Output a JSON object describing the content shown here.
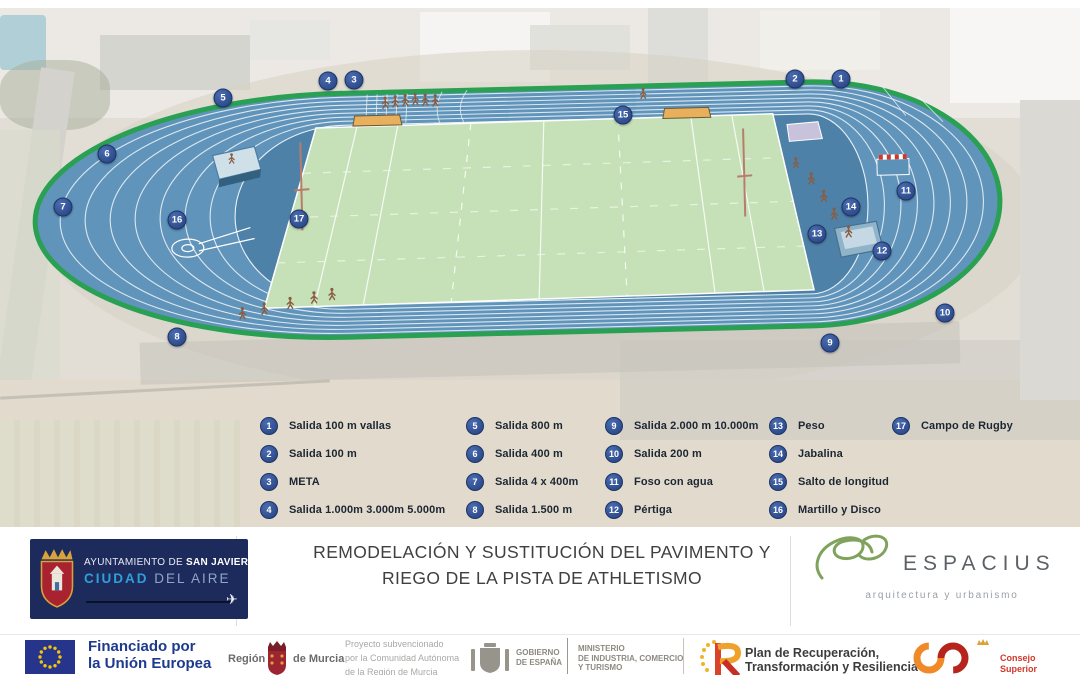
{
  "colors": {
    "track_blue": "#6094ba",
    "track_inner_blue": "#4e81a8",
    "border_green": "#2aa053",
    "field_green": "#c6e0b8",
    "marker_navy": "#2e4d90",
    "footer_navy": "#1d2a5c",
    "city_cyan": "#2f9fd8",
    "eu_blue": "#26348b",
    "eu_star_gold": "#f2c40f",
    "espacius_green": "#7fa35c",
    "csd_orange": "#f08a28",
    "csd_red": "#b5251c",
    "plan_red": "#d8432a",
    "murcia_red": "#9c2531"
  },
  "stadium": {
    "markers": [
      {
        "n": 1,
        "x": 841,
        "y": 79
      },
      {
        "n": 2,
        "x": 795,
        "y": 79
      },
      {
        "n": 3,
        "x": 354,
        "y": 80
      },
      {
        "n": 4,
        "x": 328,
        "y": 81
      },
      {
        "n": 5,
        "x": 223,
        "y": 98
      },
      {
        "n": 6,
        "x": 107,
        "y": 154
      },
      {
        "n": 7,
        "x": 63,
        "y": 207
      },
      {
        "n": 8,
        "x": 177,
        "y": 337
      },
      {
        "n": 9,
        "x": 830,
        "y": 343
      },
      {
        "n": 10,
        "x": 945,
        "y": 313
      },
      {
        "n": 11,
        "x": 906,
        "y": 191
      },
      {
        "n": 12,
        "x": 882,
        "y": 251
      },
      {
        "n": 13,
        "x": 817,
        "y": 234
      },
      {
        "n": 14,
        "x": 851,
        "y": 207
      },
      {
        "n": 15,
        "x": 623,
        "y": 115
      },
      {
        "n": 16,
        "x": 177,
        "y": 220
      },
      {
        "n": 17,
        "x": 299,
        "y": 219
      }
    ]
  },
  "legend": {
    "columns": [
      {
        "items": [
          {
            "n": 1,
            "label": "Salida 100 m vallas"
          },
          {
            "n": 2,
            "label": "Salida 100 m"
          },
          {
            "n": 3,
            "label": "META"
          },
          {
            "n": 4,
            "label": "Salida 1.000m 3.000m 5.000m"
          }
        ]
      },
      {
        "items": [
          {
            "n": 5,
            "label": "Salida 800 m"
          },
          {
            "n": 6,
            "label": "Salida 400 m"
          },
          {
            "n": 7,
            "label": "Salida 4 x 400m"
          },
          {
            "n": 8,
            "label": "Salida 1.500 m"
          }
        ]
      },
      {
        "items": [
          {
            "n": 9,
            "label": "Salida 2.000 m 10.000m"
          },
          {
            "n": 10,
            "label": "Salida 200 m"
          },
          {
            "n": 11,
            "label": "Foso con agua"
          },
          {
            "n": 12,
            "label": "Pértiga"
          }
        ]
      },
      {
        "items": [
          {
            "n": 13,
            "label": "Peso"
          },
          {
            "n": 14,
            "label": "Jabalina"
          },
          {
            "n": 15,
            "label": "Salto de longitud"
          },
          {
            "n": 16,
            "label": "Martillo y Disco"
          }
        ]
      },
      {
        "items": [
          {
            "n": 17,
            "label": "Campo de Rugby"
          }
        ]
      }
    ]
  },
  "branding": {
    "san_javier": {
      "pre": "AYUNTAMIENTO DE ",
      "name": "SAN JAVIER",
      "city_word": "CIUDAD",
      "city_rest": " DEL AIRE"
    },
    "title": {
      "line1": "REMODELACIÓN Y SUSTITUCIÓN DEL PAVIMENTO Y",
      "line2": "RIEGO DE LA PISTA DE ATHLETISMO"
    },
    "espacius": {
      "name": "ESPACIUS",
      "subtitle": "arquitectura y urbanismo"
    }
  },
  "funding": {
    "eu": {
      "line1": "Financiado por",
      "line2": "la Unión Europea",
      "line3": "NextGenerationEU"
    },
    "murcia": {
      "word_left": "Región",
      "word_right": "de Murcia",
      "note_line1": "Proyecto subvencionado",
      "note_line2": "por la Comunidad Autónoma",
      "note_line3": "de la Región de Murcia"
    },
    "gobierno": {
      "line1": "GOBIERNO",
      "line2": "DE ESPAÑA"
    },
    "ministerio": {
      "line1": "MINISTERIO",
      "line2": "DE INDUSTRIA, COMERCIO",
      "line3": "Y TURISMO"
    },
    "plan": {
      "line1": "Plan de Recuperación,",
      "line2": "Transformación y Resiliencia"
    },
    "csd": {
      "line1": "Consejo",
      "line2": "Superior",
      "line3": "de Deportes"
    }
  }
}
